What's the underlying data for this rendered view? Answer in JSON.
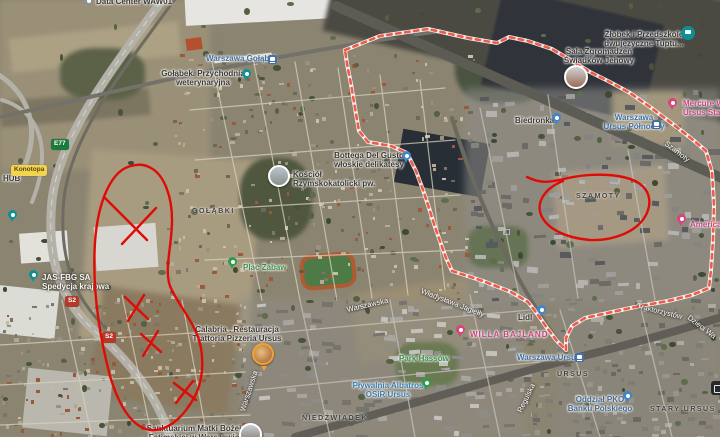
{
  "annotations": {
    "boundary_color": "#f05a47",
    "draw_color": "#e00b07"
  },
  "badges": {
    "e77": "E77",
    "s2": "S2",
    "konotopa": "Konotopa"
  },
  "districts": {
    "golabki": "GOŁĄBKI",
    "szamoty": "SZAMOTY",
    "niedzwiadek": "NIEDŹWIADEK",
    "ursus": "URSUS",
    "stary_ursus": "STARY URSUS"
  },
  "streets": {
    "warszawska_a": "Warszawska",
    "warszawska_b": "Warszawska",
    "wladyslawa": "Władysława Jagiełły",
    "traktorzystow": "Traktorzystów",
    "dzieci": "Dzieci Wa",
    "regulska": "Regulska",
    "szamoty": "Szamoty"
  },
  "stations": {
    "golabki": "Warszawa Gołąbki",
    "ursus": "Warszawa Ursus",
    "polnocny_l1": "Warszawa",
    "polnocny_l2": "Ursus Północny"
  },
  "pois": {
    "data_center": "Data Center WAW01",
    "vet_l1": "Gołąbek. Przychodnia",
    "vet_l2": "weterynaryjna",
    "bottega_l1": "Bottega Del Gusto",
    "bottega_l2": "włoskie delikatesy",
    "kosciol_l1": "Kościół",
    "kosciol_l2": "Rzymskokatolicki pw.",
    "zlobek_l1": "Żłobek i Przedszkole",
    "zlobek_l2": "dwujęzyczne Tuptu...",
    "sala_l1": "Sala Zgromadzeń",
    "sala_l2": "Świadków Jehowy",
    "biedronka": "Biedronka",
    "mercure_l1": "Mercure W",
    "mercure_l2": "Ursus Stat",
    "america": "American",
    "jas_l1": "JAS-FBG SA",
    "jas_l2": "Spedycja krajowa",
    "hub": "HUB",
    "plac_zabaw": "Plac Zabaw",
    "calabria_l1": "Calabria . Restauracja",
    "calabria_l2": "Trattoria Pizzeria Ursus",
    "park_hassow": "Park Hassów",
    "willa": "WILLA BAJLAND",
    "lidl": "Lidl",
    "plywalnia_l1": "Pływalnia Albatros",
    "plywalnia_l2": "OSiR Ursus",
    "pko_l1": "Oddział PKO",
    "pko_l2": "Banku Polskiego",
    "sanktuarium_l1": "Sanktuarium Matki Bożej",
    "sanktuarium_l2": "Fatimskiej w Warszawie"
  }
}
